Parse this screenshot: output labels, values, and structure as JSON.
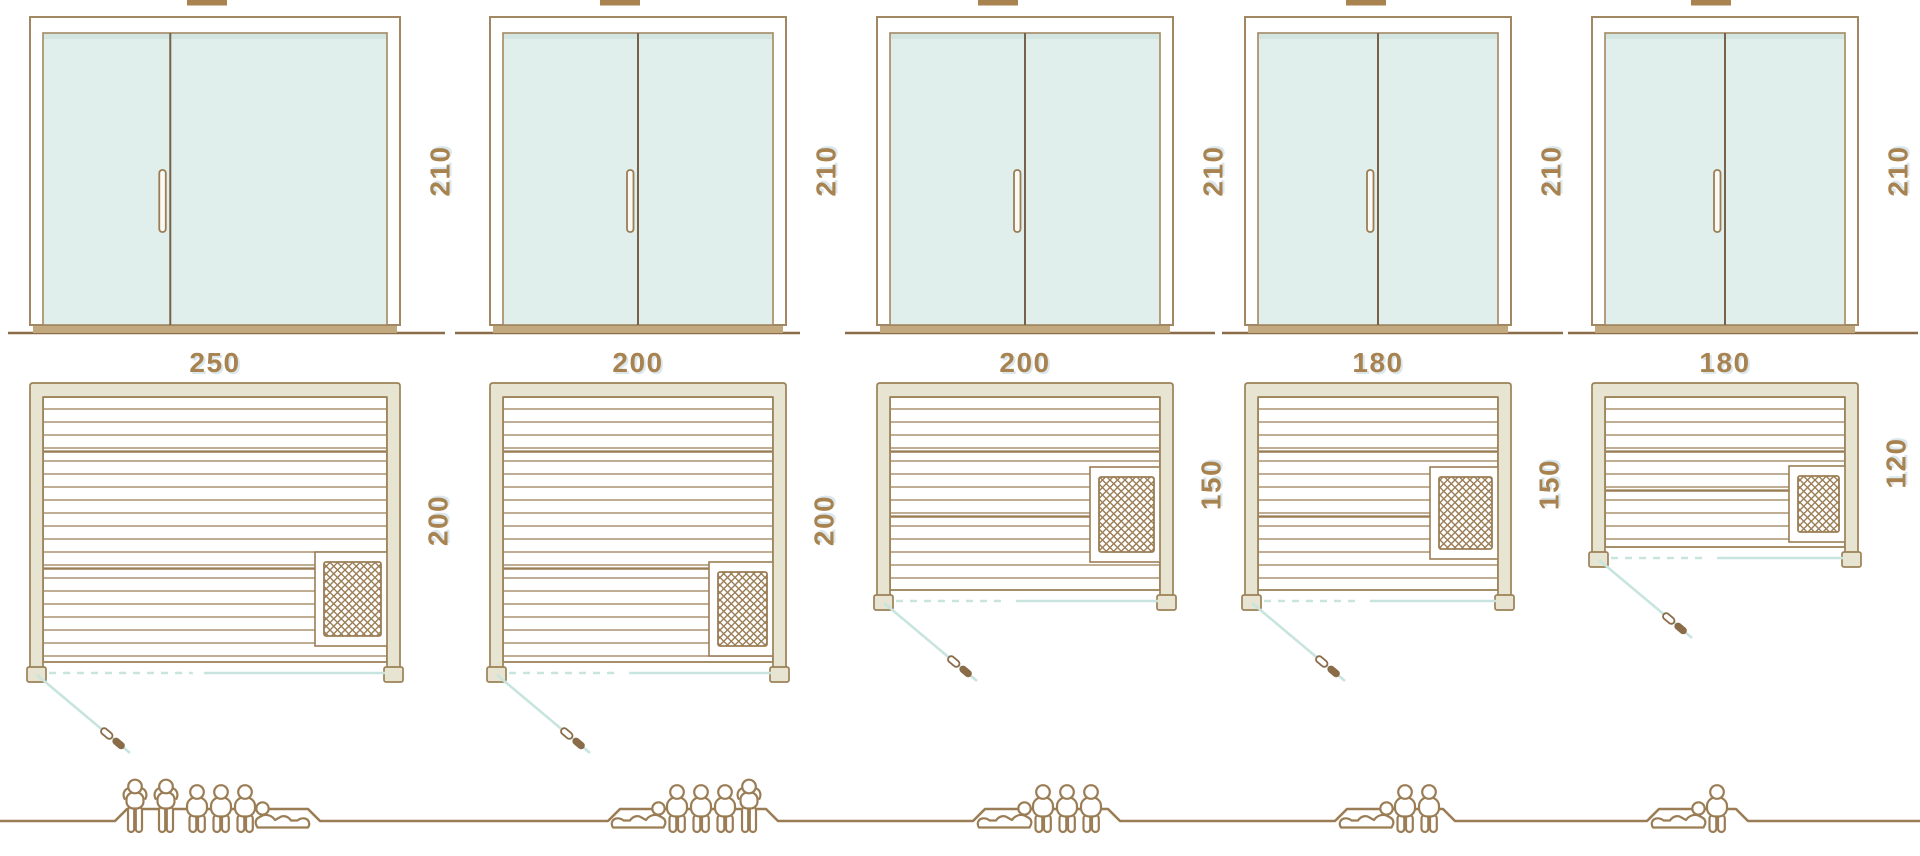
{
  "diagram": {
    "kind": "sauna size comparison technical drawing",
    "views": [
      "front door elevation",
      "floor plan",
      "seating capacity figures"
    ],
    "units": [
      {
        "width_label": "250",
        "door_height_label": "210",
        "depth_label": "200",
        "heater_position": "bottom-right",
        "capacity": {
          "standing": 2,
          "sitting": 3,
          "lying": 1,
          "total": 6
        }
      },
      {
        "width_label": "200",
        "door_height_label": "210",
        "depth_label": "200",
        "heater_position": "bottom-right",
        "capacity": {
          "standing": 1,
          "sitting": 3,
          "lying": 1,
          "total": 5
        }
      },
      {
        "width_label": "200",
        "door_height_label": "210",
        "depth_label": "150",
        "heater_position": "middle-right",
        "capacity": {
          "standing": 0,
          "sitting": 3,
          "lying": 1,
          "total": 4
        }
      },
      {
        "width_label": "180",
        "door_height_label": "210",
        "depth_label": "150",
        "heater_position": "middle-right",
        "capacity": {
          "standing": 0,
          "sitting": 2,
          "lying": 1,
          "total": 3
        }
      },
      {
        "width_label": "180",
        "door_height_label": "210",
        "depth_label": "120",
        "heater_position": "middle-right",
        "capacity": {
          "standing": 0,
          "sitting": 1,
          "lying": 1,
          "total": 2
        }
      }
    ]
  },
  "colors": {
    "line": "#9b7d55",
    "line_dark": "#8a6c49",
    "label_text": "#a8834f",
    "wall_fill": "#e7e4d2",
    "wall_stroke": "#9c8257",
    "glass_fill": "#e1efec",
    "glass_shade": "#cfe2de",
    "glass_stroke": "#a18862",
    "swing_blue": "#c8e4df",
    "threshold": "#c2a87e",
    "handle_fill": "#fbf9f3"
  }
}
